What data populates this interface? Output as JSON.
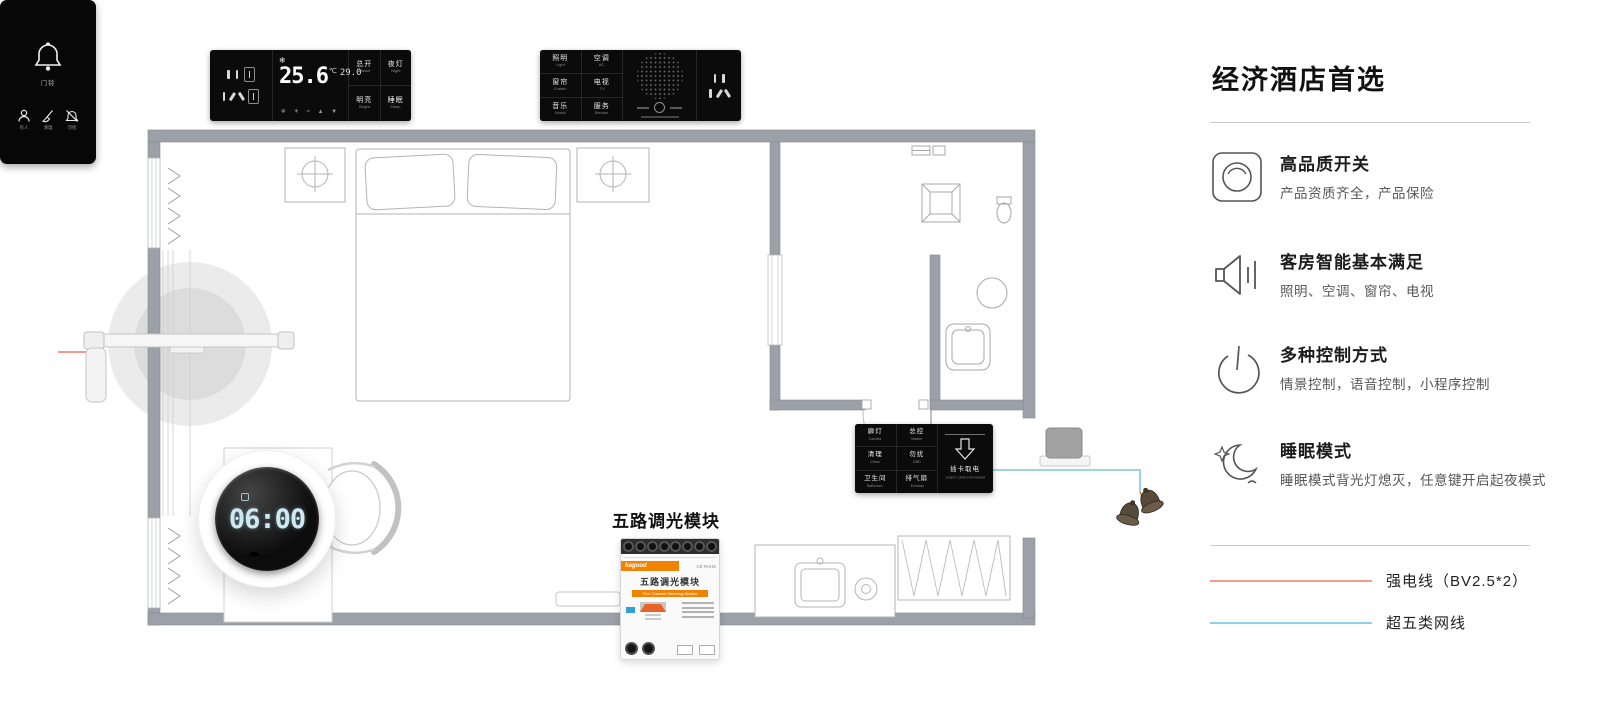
{
  "sidebar": {
    "title": "经济酒店首选",
    "features": [
      {
        "icon": "switch-icon",
        "title": "高品质开关",
        "desc": "产品资质齐全，产品保险"
      },
      {
        "icon": "speaker-icon",
        "title": "客房智能基本满足",
        "desc": "照明、空调、窗帘、电视"
      },
      {
        "icon": "power-icon",
        "title": "多种控制方式",
        "desc": "情景控制，语音控制，小程序控制"
      },
      {
        "icon": "moon-icon",
        "title": "睡眠模式",
        "desc": "睡眠模式背光灯熄灭，任意键开启起夜模式"
      }
    ],
    "legend": [
      {
        "label": "强电线（BV2.5*2）",
        "color": "#ef9c8f"
      },
      {
        "label": "超五类网线",
        "color": "#8fcfe8"
      }
    ]
  },
  "thermostat_panel": {
    "snowflake": "❄",
    "temp": "25.6",
    "unit": "℃",
    "setpoint": "29.0",
    "mode_icons": "❄ ☀ ≈ ▲ ▼",
    "buttons": [
      {
        "cn": "总开",
        "en": "Master"
      },
      {
        "cn": "夜灯",
        "en": "Night"
      },
      {
        "cn": "明亮",
        "en": "Bright"
      },
      {
        "cn": "睡眠",
        "en": "Sleep"
      }
    ]
  },
  "scene_panel": {
    "buttons": [
      {
        "cn": "照明",
        "en": "Light"
      },
      {
        "cn": "空调",
        "en": "AC"
      },
      {
        "cn": "窗帘",
        "en": "Curtain"
      },
      {
        "cn": "电视",
        "en": "TV"
      },
      {
        "cn": "音乐",
        "en": "Music"
      },
      {
        "cn": "服务",
        "en": "Service"
      }
    ]
  },
  "card_panel": {
    "buttons": [
      {
        "cn": "廊灯",
        "en": "Corridor"
      },
      {
        "cn": "总控",
        "en": "Master"
      },
      {
        "cn": "清理",
        "en": "Clean"
      },
      {
        "cn": "勿扰",
        "en": "DND"
      },
      {
        "cn": "卫生间",
        "en": "Bathroom"
      },
      {
        "cn": "排气扇",
        "en": "Exhaust"
      }
    ],
    "insert_cn": "插卡取电",
    "insert_en": "INSERT CARD FOR POWER"
  },
  "door_panel": {
    "bell_label": "门铃",
    "icons": [
      {
        "name": "person-icon",
        "label": "有人"
      },
      {
        "name": "clean-icon",
        "label": "清理"
      },
      {
        "name": "dnd-icon",
        "label": "勿扰"
      }
    ]
  },
  "dimmer_module": {
    "callout": "五路调光模块",
    "brand": "hagood",
    "certs": "CE  RoHS",
    "title": "五路调光模块",
    "subtitle": "Five Channel Dimming Module"
  },
  "clock": {
    "time": "06:00"
  }
}
